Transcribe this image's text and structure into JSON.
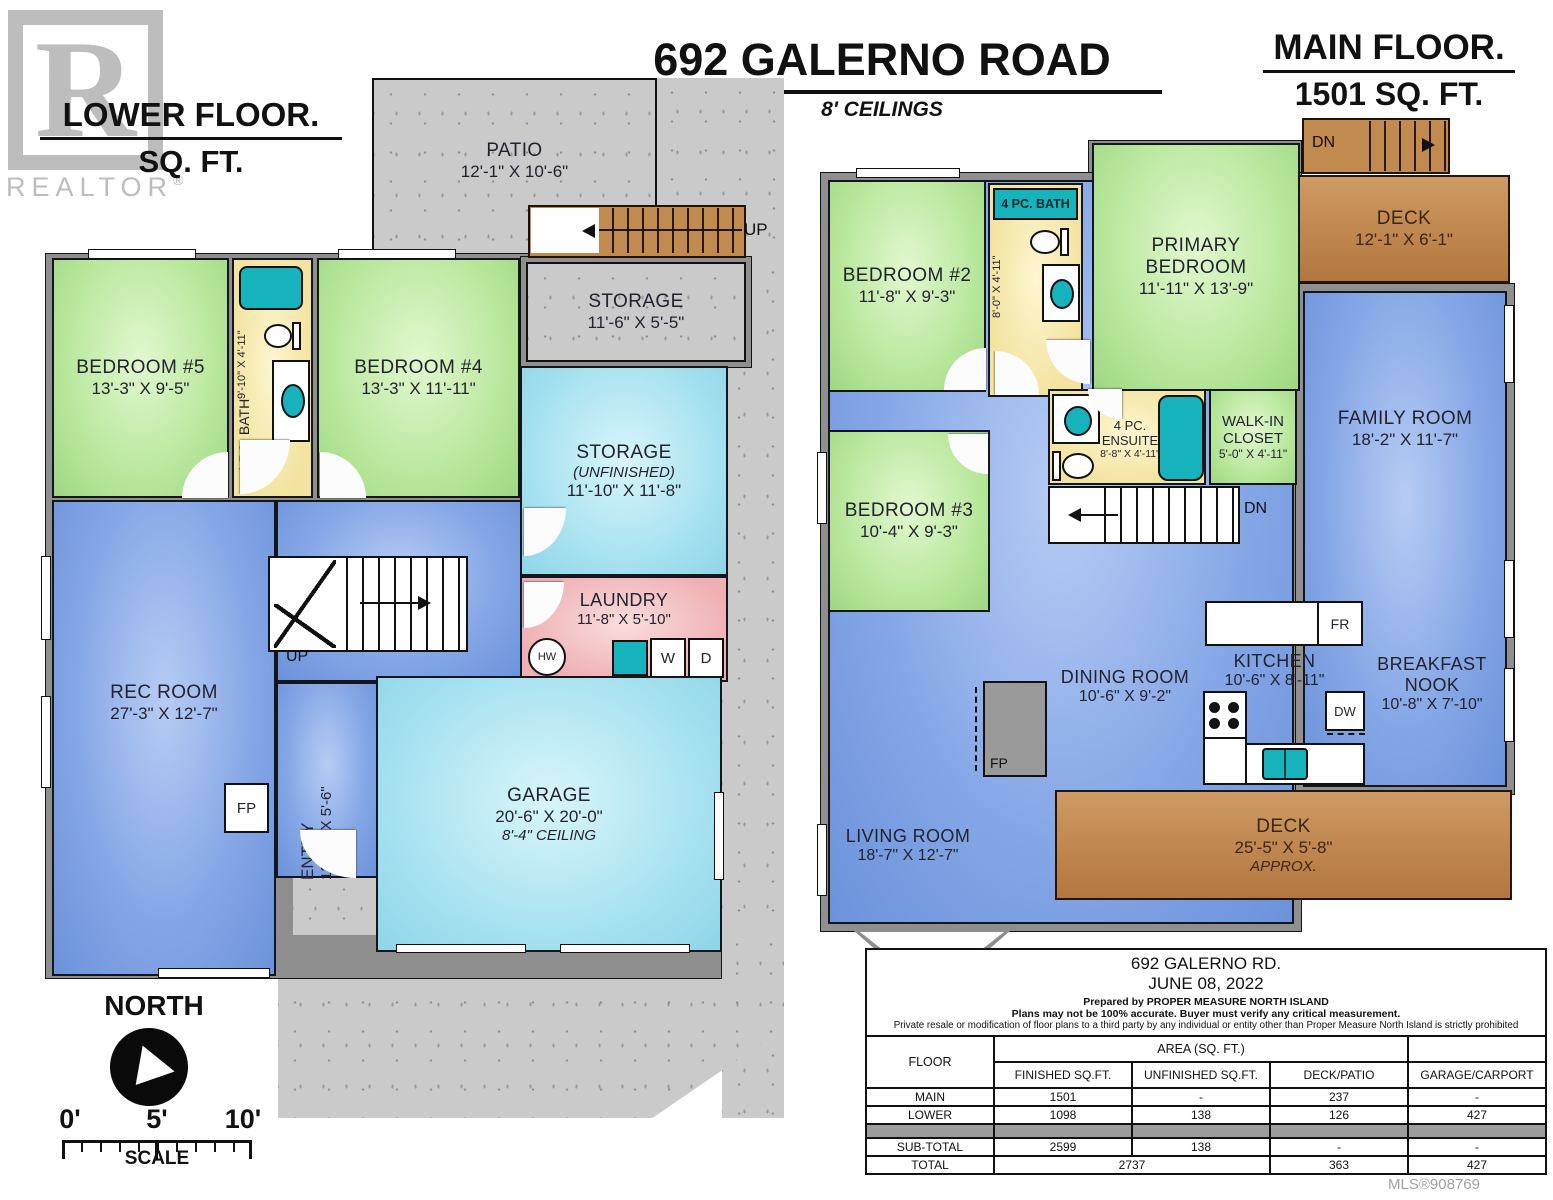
{
  "header": {
    "lower_floor_title": "LOWER FLOOR.",
    "lower_floor_sqft": "SQ. FT.",
    "address_title": "692 GALERNO ROAD",
    "ceilings": "8' CEILINGS",
    "main_floor_title": "MAIN FLOOR.",
    "main_floor_sqft": "1501 SQ. FT.",
    "realtor_r": "R",
    "realtor_watermark": "REALTOR",
    "realtor_reg": "®"
  },
  "lower_floor": {
    "patio": {
      "name": "PATIO",
      "dims": "12'-1\" X 10'-6\""
    },
    "storage_ext": {
      "name": "STORAGE",
      "dims": "11'-6\" X 5'-5\""
    },
    "bedroom5": {
      "name": "BEDROOM #5",
      "dims": "13'-3\" X 9'-5\""
    },
    "bath": {
      "name": "4 PC. BATH",
      "dims": "9'-10\" X 4'-11\""
    },
    "bedroom4": {
      "name": "BEDROOM #4",
      "dims": "13'-3\" X 11'-11\""
    },
    "storage_unf": {
      "name": "STORAGE",
      "sub": "(UNFINISHED)",
      "dims": "11'-10\" X 11'-8\""
    },
    "laundry": {
      "name": "LAUNDRY",
      "dims": "11'-8\" X 5'-10\""
    },
    "rec_room": {
      "name": "REC ROOM",
      "dims": "27'-3\" X 12'-7\""
    },
    "entry": {
      "name": "ENTRY",
      "dims": "13'-11\" X 5'-6\""
    },
    "garage": {
      "name": "GARAGE",
      "dims": "20'-6\" X 20'-0\"",
      "ceiling": "8'-4\" CEILING"
    },
    "labels": {
      "up_ext": "UP",
      "up_int": "UP",
      "fp": "FP",
      "hw": "HW",
      "cv": "CV",
      "washer": "W",
      "dryer": "D"
    }
  },
  "main_floor": {
    "deck_top": {
      "name": "DECK",
      "dims": "12'-1\" X 6'-1\""
    },
    "bedroom2": {
      "name": "BEDROOM #2",
      "dims": "11'-8\" X 9'-3\""
    },
    "bath": {
      "name": "4 PC. BATH",
      "dims": "8'-0\" X 4'-11\""
    },
    "primary": {
      "name1": "PRIMARY",
      "name2": "BEDROOM",
      "dims": "11'-11\" X 13'-9\""
    },
    "family": {
      "name": "FAMILY ROOM",
      "dims": "18'-2\" X 11'-7\""
    },
    "ensuite": {
      "name1": "4 PC.",
      "name2": "ENSUITE",
      "dims": "8'-8\" X 4'-11\""
    },
    "closet": {
      "name1": "WALK-IN",
      "name2": "CLOSET",
      "dims": "5'-0\" X 4'-11\""
    },
    "bedroom3": {
      "name": "BEDROOM #3",
      "dims": "10'-4\" X 9'-3\""
    },
    "dining": {
      "name": "DINING ROOM",
      "dims": "10'-6\" X 9'-2\""
    },
    "kitchen": {
      "name": "KITCHEN",
      "dims": "10'-6\" X 8'-11\""
    },
    "nook": {
      "name1": "BREAKFAST",
      "name2": "NOOK",
      "dims": "10'-8\" X 7'-10\""
    },
    "living": {
      "name": "LIVING ROOM",
      "dims": "18'-7\" X 12'-7\""
    },
    "deck_bottom": {
      "name": "DECK",
      "dims": "25'-5\" X 5'-8\"",
      "approx": "APPROX."
    },
    "labels": {
      "dn_top": "DN",
      "dn_stairs": "DN",
      "fr": "FR",
      "dw": "DW",
      "fp": "FP"
    }
  },
  "compass": {
    "label": "NORTH"
  },
  "scale_bar": {
    "t0": "0'",
    "t5": "5'",
    "t10": "10'",
    "label": "SCALE"
  },
  "info_table": {
    "address": "692 GALERNO RD.",
    "date": "JUNE 08, 2022",
    "prepared": "Prepared by PROPER MEASURE NORTH ISLAND",
    "disclaimer1": "Plans may not be 100% accurate.  Buyer must verify any critical measurement.",
    "disclaimer2": "Private resale  or modification of floor plans to a third party by any individual or entity other than Proper Measure North Island is strictly prohibited",
    "col_floor": "FLOOR",
    "col_area": "AREA (SQ. FT.)",
    "col_finished": "FINISHED SQ.FT.",
    "col_unfinished": "UNFINISHED SQ.FT.",
    "col_deck": "DECK/PATIO",
    "col_garage": "GARAGE/CARPORT",
    "rows": [
      {
        "floor": "MAIN",
        "finished": "1501",
        "unfinished": "-",
        "deck": "237",
        "garage": "-"
      },
      {
        "floor": "LOWER",
        "finished": "1098",
        "unfinished": "138",
        "deck": "126",
        "garage": "427"
      }
    ],
    "subtotal": {
      "floor": "SUB-TOTAL",
      "finished": "2599",
      "unfinished": "138",
      "deck": "-",
      "garage": "-"
    },
    "total": {
      "floor": "TOTAL",
      "finished_combined": "2737",
      "deck": "363",
      "garage": "427"
    }
  },
  "mls": "MLS®908769",
  "colors": {
    "wall_gray": "#8f8f8f",
    "concrete": "#cacaca",
    "room_green": "#b8e79c",
    "room_blue": "#84a6e6",
    "room_cyan": "#a8e2f0",
    "room_yellow": "#f3e3a0",
    "room_pink": "#efb0b4",
    "fixture_teal": "#17b3bd",
    "deck_brown": "#c0854e"
  }
}
